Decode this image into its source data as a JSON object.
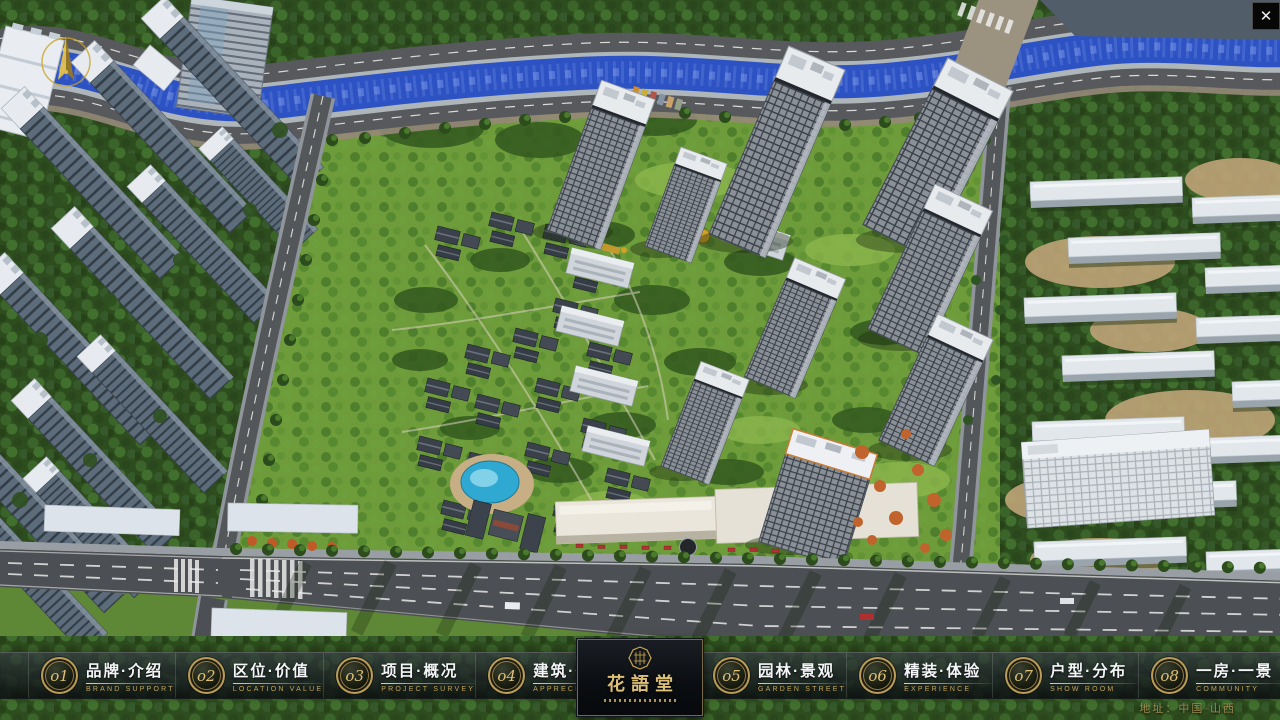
{
  "colors": {
    "accent_gold": "#c2a35c",
    "gold_bright": "#dcc078",
    "nav_text": "#f3f5f7",
    "river_blue": "#2c52c4",
    "pool_cyan": "#2fa9d2"
  },
  "window": {
    "close_glyph": "✕"
  },
  "nav": {
    "items": [
      {
        "num": "o1",
        "zh": "品牌·介绍",
        "en": "BRAND SUPPORT"
      },
      {
        "num": "o2",
        "zh": "区位·价值",
        "en": "LOCATION VALUE"
      },
      {
        "num": "o3",
        "zh": "项目·概况",
        "en": "PROJECT SURVEY"
      },
      {
        "num": "o4",
        "zh": "建筑·鉴赏",
        "en": "APPRECIATION"
      },
      {
        "num": "o5",
        "zh": "园林·景观",
        "en": "GARDEN STREET"
      },
      {
        "num": "o6",
        "zh": "精装·体验",
        "en": "EXPERIENCE"
      },
      {
        "num": "o7",
        "zh": "户型·分布",
        "en": "SHOW ROOM"
      },
      {
        "num": "o8",
        "zh": "一房·一景",
        "en": "COMMUNITY"
      }
    ],
    "logo": {
      "title": "花語堂"
    }
  },
  "footer": {
    "address": "地址：中国·山西"
  }
}
